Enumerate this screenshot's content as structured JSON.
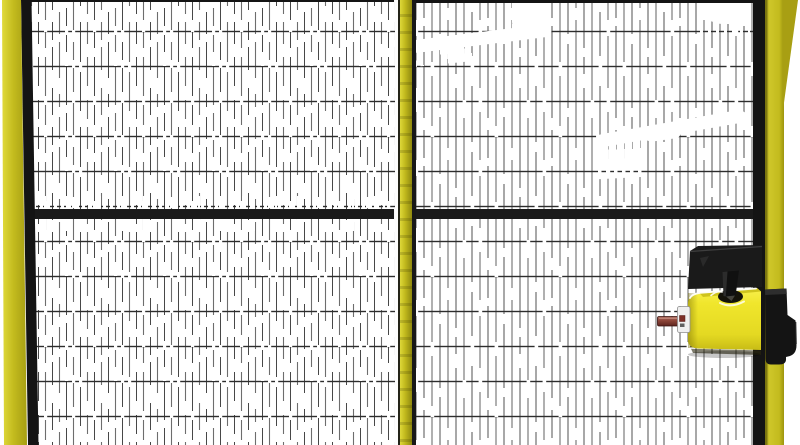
{
  "scene": {
    "description": "3D render of yellow-framed machine guarding: two black wire-mesh fence panels with yellow tube posts (left, centre, right), a black horizontal mid rail across both panels, and a yellow safety interlock switch with black mounting bracket, black door handle and maroon actuator bar mounted on the right post",
    "panels": [
      {
        "name": "left-mesh-panel",
        "mesh": "fine vertical wires with black horizontal wires, shimmering highlight gaps"
      },
      {
        "name": "right-mesh-panel",
        "mesh": "fine vertical wires with black horizontal wires, wavy white specular streaks"
      }
    ],
    "interlock": {
      "body": "yellow switch housing",
      "bracket": "black top mounting plate",
      "tongue": "black locking tongue entering housing slot",
      "actuator": "maroon horizontal actuator bar with white connector block",
      "handle": "black door handle block on right post"
    },
    "colors": {
      "background": "#ffffff",
      "post_yellow": "#c3bb1e",
      "lock_yellow": "#f0e62c",
      "frame_black": "#141414",
      "rail_black": "#1a1a1a",
      "mesh_wire": "#6d6d6d",
      "mesh_wire_dark": "#2d2d2d",
      "actuator_maroon": "#8c4438"
    }
  }
}
